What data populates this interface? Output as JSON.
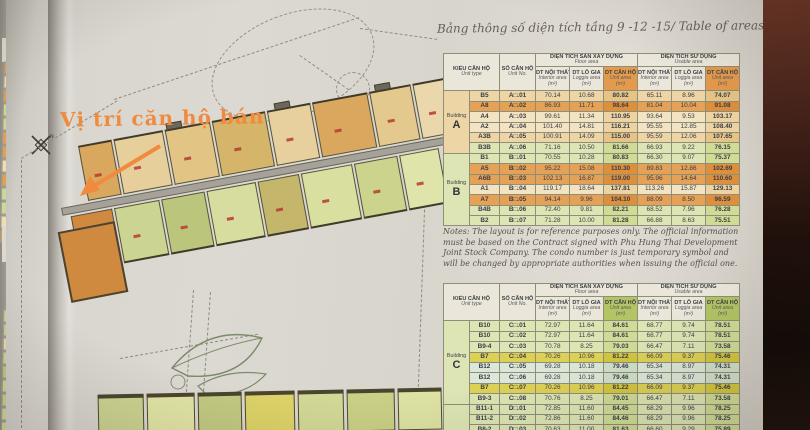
{
  "title": "Bảng thông số diện tích tầng 9 -12 -15/ Table of areas on the 9th-12th-15th floor",
  "notes": "Notes: The layout is for reference purposes only. The official information must be based on the Contract signed with Phu Hung Thai Development Joint Stock Company. The condo number is just temporary symbol and will be changed by appropriate authorities when issuing the official one.",
  "headers": {
    "unit_type_vi": "KIỂU CĂN HỘ",
    "unit_type_en": "Unit type",
    "unit_no_vi": "SỐ CĂN HỘ",
    "unit_no_en": "Unit No.",
    "floor_area_vi": "DIỆN TÍCH SÀN XÂY DỰNG",
    "floor_area_en": "Floor area",
    "usable_area_vi": "DIỆN TÍCH SỬ DỤNG",
    "usable_area_en": "Usable area",
    "interior_vi": "DT NỘI THẤT",
    "interior_en": "Interior area",
    "loggia_vi": "DT LÔ GIA",
    "loggia_en": "Loggia area",
    "unit_vi": "DT CĂN HỘ",
    "unit_en": "Unit area",
    "sqm": "(m²)"
  },
  "area_tables": [
    {
      "accent": "#e49a4d",
      "building_groups": [
        {
          "label_word": "Building",
          "label_letter": "A",
          "rows": 6
        },
        {
          "label_word": "Building",
          "label_letter": "B",
          "rows": 7
        }
      ],
      "rows": [
        {
          "type": "B5",
          "no": "A□.01",
          "cells": [
            "70.14",
            "10.68",
            "80.82",
            "65.11",
            "8.96",
            "74.07"
          ],
          "tone": "tan"
        },
        {
          "type": "A8",
          "no": "A□.02",
          "cells": [
            "86.93",
            "11.71",
            "98.64",
            "81.04",
            "10.04",
            "91.08"
          ],
          "tone": "orange"
        },
        {
          "type": "A4",
          "no": "A□.03",
          "cells": [
            "99.61",
            "11.34",
            "110.95",
            "93.64",
            "9.53",
            "103.17"
          ],
          "tone": "cream"
        },
        {
          "type": "A2",
          "no": "A□.04",
          "cells": [
            "101.40",
            "14.81",
            "116.21",
            "95.55",
            "12.85",
            "108.40"
          ],
          "tone": "cream"
        },
        {
          "type": "A3B",
          "no": "A□.05",
          "cells": [
            "100.91",
            "14.09",
            "115.00",
            "95.59",
            "12.06",
            "107.65"
          ],
          "tone": "tan"
        },
        {
          "type": "B3B",
          "no": "A□.06",
          "cells": [
            "71.16",
            "10.50",
            "81.66",
            "66.93",
            "9.22",
            "76.15"
          ],
          "tone": "green"
        },
        {
          "type": "B1",
          "no": "B□.01",
          "cells": [
            "70.55",
            "10.28",
            "80.83",
            "66.30",
            "9.07",
            "75.37"
          ],
          "tone": "green"
        },
        {
          "type": "A5",
          "no": "B□.02",
          "cells": [
            "95.22",
            "15.08",
            "110.30",
            "89.83",
            "12.86",
            "102.69"
          ],
          "tone": "orange"
        },
        {
          "type": "A6B",
          "no": "B□.03",
          "cells": [
            "102.13",
            "16.87",
            "119.00",
            "95.96",
            "14.64",
            "110.60"
          ],
          "tone": "orange"
        },
        {
          "type": "A1",
          "no": "B□.04",
          "cells": [
            "119.17",
            "18.64",
            "137.81",
            "113.26",
            "15.87",
            "129.13"
          ],
          "tone": "cream"
        },
        {
          "type": "A7",
          "no": "B□.05",
          "cells": [
            "94.14",
            "9.96",
            "104.10",
            "88.09",
            "8.50",
            "96.59"
          ],
          "tone": "orange"
        },
        {
          "type": "B4B",
          "no": "B□.06",
          "cells": [
            "72.40",
            "9.81",
            "82.21",
            "68.52",
            "7.96",
            "76.28"
          ],
          "tone": "green"
        },
        {
          "type": "B2",
          "no": "B□.07",
          "cells": [
            "71.28",
            "10.00",
            "81.28",
            "66.88",
            "8.63",
            "75.51"
          ],
          "tone": "green"
        }
      ]
    },
    {
      "accent": "#b2c464",
      "building_groups": [
        {
          "label_word": "Building",
          "label_letter": "C",
          "rows": 8
        },
        {
          "label_word": "",
          "label_letter": "",
          "rows": 3
        }
      ],
      "rows": [
        {
          "type": "B10",
          "no": "C□.01",
          "cells": [
            "72.97",
            "11.64",
            "84.61",
            "68.77",
            "9.74",
            "78.51"
          ],
          "tone": "green"
        },
        {
          "type": "B10",
          "no": "C□.02",
          "cells": [
            "72.97",
            "11.64",
            "84.61",
            "68.77",
            "9.74",
            "78.51"
          ],
          "tone": "green"
        },
        {
          "type": "B9-4",
          "no": "C□.03",
          "cells": [
            "70.78",
            "8.25",
            "79.03",
            "66.47",
            "7.11",
            "73.58"
          ],
          "tone": "green"
        },
        {
          "type": "B7",
          "no": "C□.04",
          "cells": [
            "70.26",
            "10.96",
            "81.22",
            "66.09",
            "9.37",
            "75.46"
          ],
          "tone": "yellow"
        },
        {
          "type": "B12",
          "no": "C□.05",
          "cells": [
            "69.28",
            "10.18",
            "79.46",
            "65.34",
            "8.97",
            "74.31"
          ],
          "tone": "teal"
        },
        {
          "type": "B12",
          "no": "C□.06",
          "cells": [
            "69.28",
            "10.18",
            "79.46",
            "65.34",
            "8.97",
            "74.31"
          ],
          "tone": "teal"
        },
        {
          "type": "B7",
          "no": "C□.07",
          "cells": [
            "70.26",
            "10.96",
            "81.22",
            "66.09",
            "9.37",
            "75.46"
          ],
          "tone": "yellow"
        },
        {
          "type": "B9-3",
          "no": "C□.08",
          "cells": [
            "70.76",
            "8.25",
            "79.01",
            "66.47",
            "7.11",
            "73.58"
          ],
          "tone": "green"
        },
        {
          "type": "B11-1",
          "no": "D□.01",
          "cells": [
            "72.85",
            "11.60",
            "84.45",
            "68.29",
            "9.96",
            "78.25"
          ],
          "tone": "green"
        },
        {
          "type": "B11-2",
          "no": "D□.02",
          "cells": [
            "72.86",
            "11.60",
            "84.46",
            "68.29",
            "9.96",
            "78.25"
          ],
          "tone": "green"
        },
        {
          "type": "B8-2",
          "no": "D□.03",
          "cells": [
            "70.63",
            "11.00",
            "81.63",
            "66.60",
            "9.29",
            "75.89"
          ],
          "tone": "green"
        }
      ]
    }
  ],
  "photo": {
    "site_plan": {
      "annotation": "Vị trí căn hộ bán",
      "compass_label": "N",
      "sale_unit_color": "#d08a3f",
      "upper_unit_colors": [
        "#d9a75e",
        "#e7cf9b",
        "#e2c485",
        "#d5b569",
        "#e8d09e",
        "#d9a75e",
        "#e4c98f",
        "#ead8ac"
      ],
      "lower_unit_colors": [
        "#d08a3f",
        "#ccd491",
        "#bcc57c",
        "#d6dd9e",
        "#c4b76b",
        "#d8df9f",
        "#ccd38c",
        "#dfe5aa"
      ],
      "bottom_strip_colors": [
        "#ccd492",
        "#e2e5a6",
        "#c2ca82",
        "#ddd368",
        "#d2d995",
        "#cad086",
        "#dde3a3"
      ]
    },
    "edge_page_rows_top": [
      "#e2a055",
      "#f0ddb5",
      "#e2a055",
      "#ccd89a",
      "#ccd89a",
      "#e2a055",
      "#e2a055",
      "#f0ddb5",
      "#e2a055",
      "#ccd89a",
      "#ccd89a",
      "#f0ddb5",
      "#e2a055"
    ],
    "edge_page_rows_bottom": [
      "#ccd89a",
      "#c5d28f",
      "#e8d9a8",
      "#ccd89a",
      "#bfcc86",
      "#ccd89a",
      "#c5d28f",
      "#ccd89a",
      "#ccd89a",
      "#c5d28f"
    ]
  }
}
